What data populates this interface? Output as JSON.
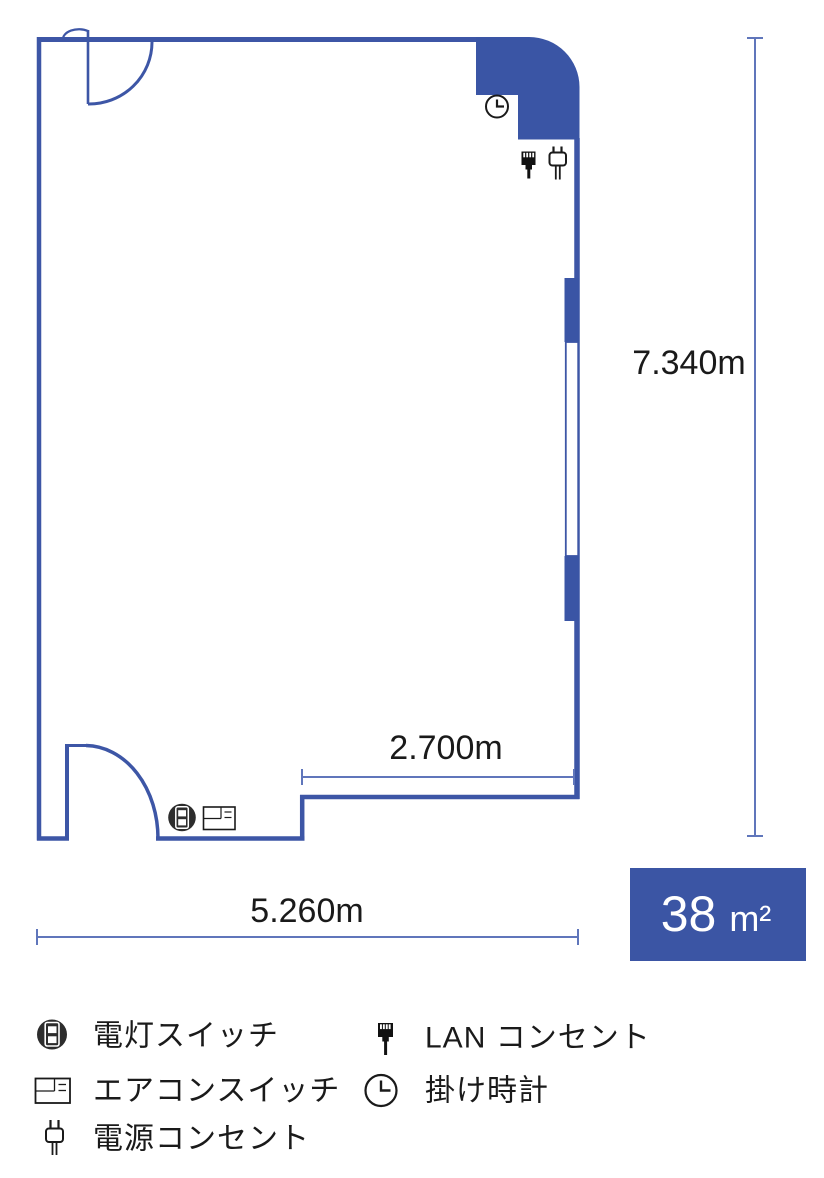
{
  "floor_plan": {
    "dim_height": "7.340m",
    "dim_partial_width": "2.700m",
    "dim_width": "5.260m",
    "area_value": "38",
    "area_unit": "m²",
    "colors": {
      "wall": "#3d56a6",
      "pillar_fill": "#3a55a5",
      "dimension_line": "#6076bb",
      "area_box": "#3b55a4",
      "text": "#1a1a1a",
      "area_text": "#ffffff",
      "switch_icon_dark": "#2d2d2d"
    },
    "markers": [
      {
        "icon": "wall-clock-icon"
      },
      {
        "icon": "lan-outlet-icon"
      },
      {
        "icon": "power-outlet-icon"
      },
      {
        "icon": "light-switch-icon"
      },
      {
        "icon": "aircon-switch-icon"
      }
    ]
  },
  "legend": {
    "items": [
      {
        "icon": "light-switch-icon",
        "label": "電灯スイッチ"
      },
      {
        "icon": "aircon-switch-icon",
        "label": "エアコンスイッチ"
      },
      {
        "icon": "power-outlet-icon",
        "label": "電源コンセント"
      },
      {
        "icon": "lan-outlet-icon",
        "label": "LAN コンセント"
      },
      {
        "icon": "wall-clock-icon",
        "label": "掛け時計"
      }
    ]
  }
}
